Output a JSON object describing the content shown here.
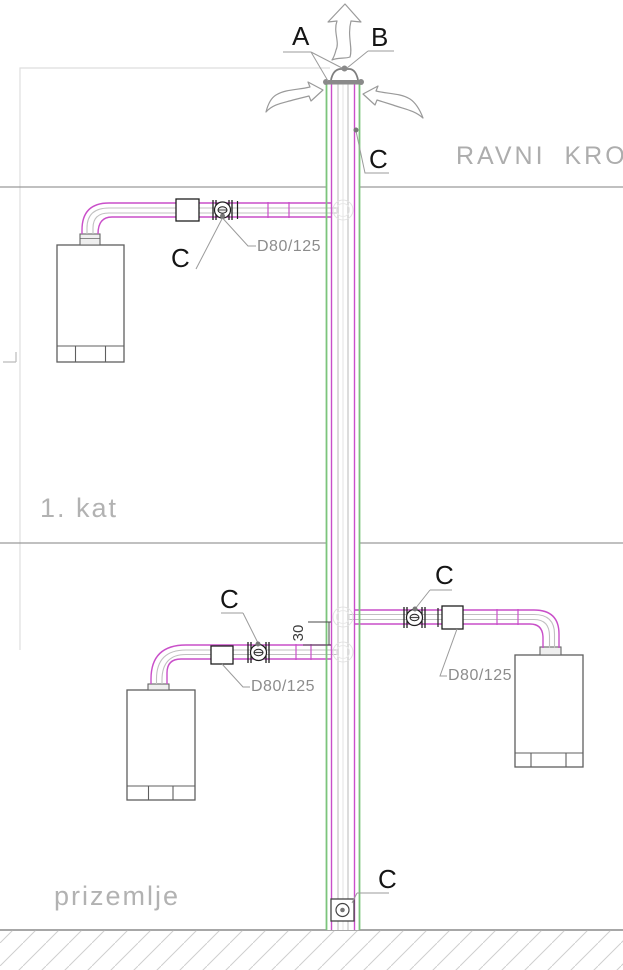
{
  "drawing_type": "flue-chimney-schematic",
  "colors": {
    "flue_magenta": "#c94fc9",
    "chimney_green": "#7cc47c",
    "line_gray": "#999999",
    "muted_text": "#b2b2b2",
    "label_black": "#151515"
  },
  "floor_labels": {
    "roof": "RAVNI KROV",
    "first_floor": "1. kat",
    "ground_floor": "prizemlje"
  },
  "callouts": {
    "a": "A",
    "b": "B",
    "c_roof": "C",
    "c_first_floor": "C",
    "c_ground_right": "C",
    "c_ground_left": "C",
    "c_base": "C",
    "size_first_floor": "D80/125",
    "size_ground_right": "D80/125",
    "size_ground_left": "D80/125",
    "offset_dimension": "30"
  },
  "symbols": {
    "exhaust_arrow": "up-arrow-icon",
    "intake_arrow_left": "curved-arrow-icon",
    "intake_arrow_right": "curved-arrow-icon",
    "inspection_fitting": "circle-inspection-port",
    "cleanout": "base-cleanout-port"
  }
}
